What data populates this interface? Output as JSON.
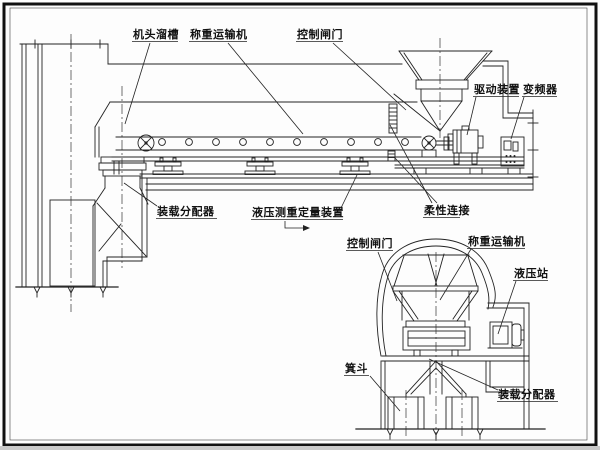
{
  "diagram": {
    "type": "engineering-schematic",
    "colors": {
      "background": "#fdfdfd",
      "line": "#222222",
      "text": "#111111"
    },
    "side_view": {
      "labels": {
        "head_chute": "机头溜槽",
        "weighing_conveyor": "称重运输机",
        "control_gate": "控制闸门",
        "drive_unit": "驱动装置",
        "frequency_converter": "变频器",
        "loading_distributor": "装载分配器",
        "hydraulic_weighing_device": "液压测重定量装置",
        "flexible_connection": "柔性连接"
      }
    },
    "section_view": {
      "labels": {
        "control_gate": "控制闸门",
        "weighing_conveyor": "称重运输机",
        "hydraulic_station": "液压站",
        "skip_bucket": "箕斗",
        "loading_distributor": "装载分配器"
      }
    }
  }
}
